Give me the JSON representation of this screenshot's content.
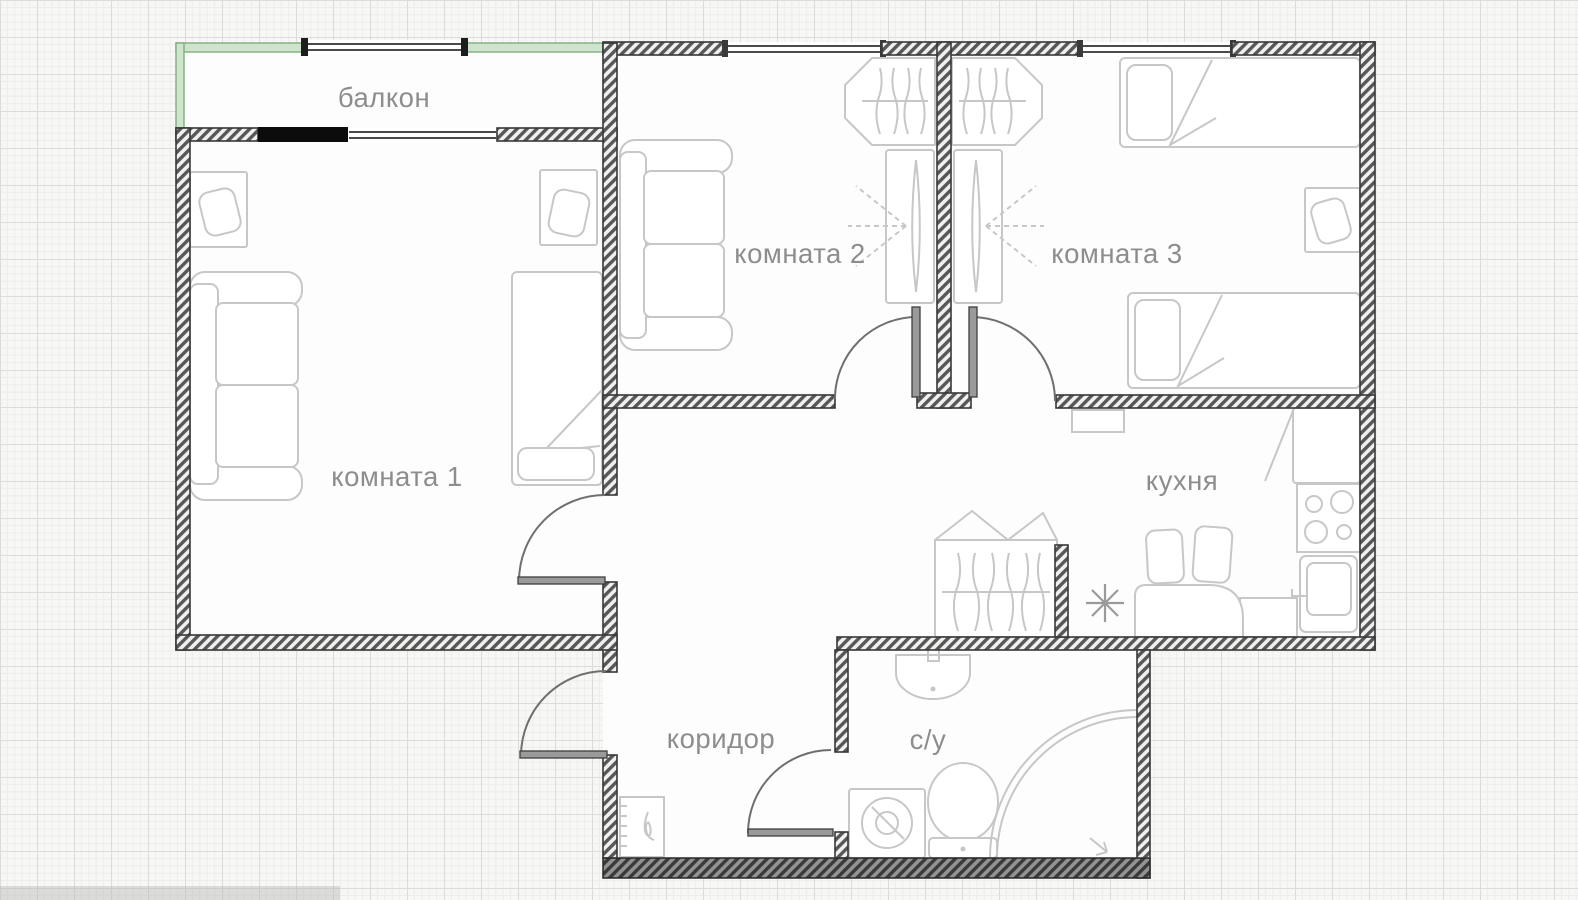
{
  "plan": {
    "title": "apartment floor plan",
    "labels": {
      "balcony": "балкон",
      "room1": "комната 1",
      "room2": "комната 2",
      "room3": "комната 3",
      "kitchen": "кухня",
      "corridor": "коридор",
      "bathroom": "с/у"
    },
    "colors": {
      "wall": "#4a4a4a",
      "balcony_wall": "#9dc49d",
      "solid_wall_segment": "#111111",
      "furniture_line": "#c7c7c7",
      "label_text": "#8d8d8d",
      "paper_grid": "#ececea"
    },
    "furniture": {
      "room1": [
        "desk-with-chair",
        "desk-with-chair",
        "sofa",
        "bed"
      ],
      "room2": [
        "sofa",
        "wardrobe",
        "tv-stand"
      ],
      "room3": [
        "wardrobe",
        "tv-stand",
        "single-bed",
        "single-bed",
        "desk-with-chair"
      ],
      "hall": [
        "open-wardrobe"
      ],
      "kitchen": [
        "fridge",
        "stove",
        "kitchen-sink",
        "counter",
        "dining-table",
        "stool",
        "stool",
        "ceiling-lamp"
      ],
      "corridor": [
        "shoe-cabinet"
      ],
      "bathroom": [
        "wash-basin",
        "toilet",
        "washing-machine",
        "corner-shower"
      ]
    },
    "openings": {
      "window_count": 4,
      "doors": [
        "entrance",
        "room1",
        "room2",
        "room3",
        "bathroom"
      ]
    }
  }
}
